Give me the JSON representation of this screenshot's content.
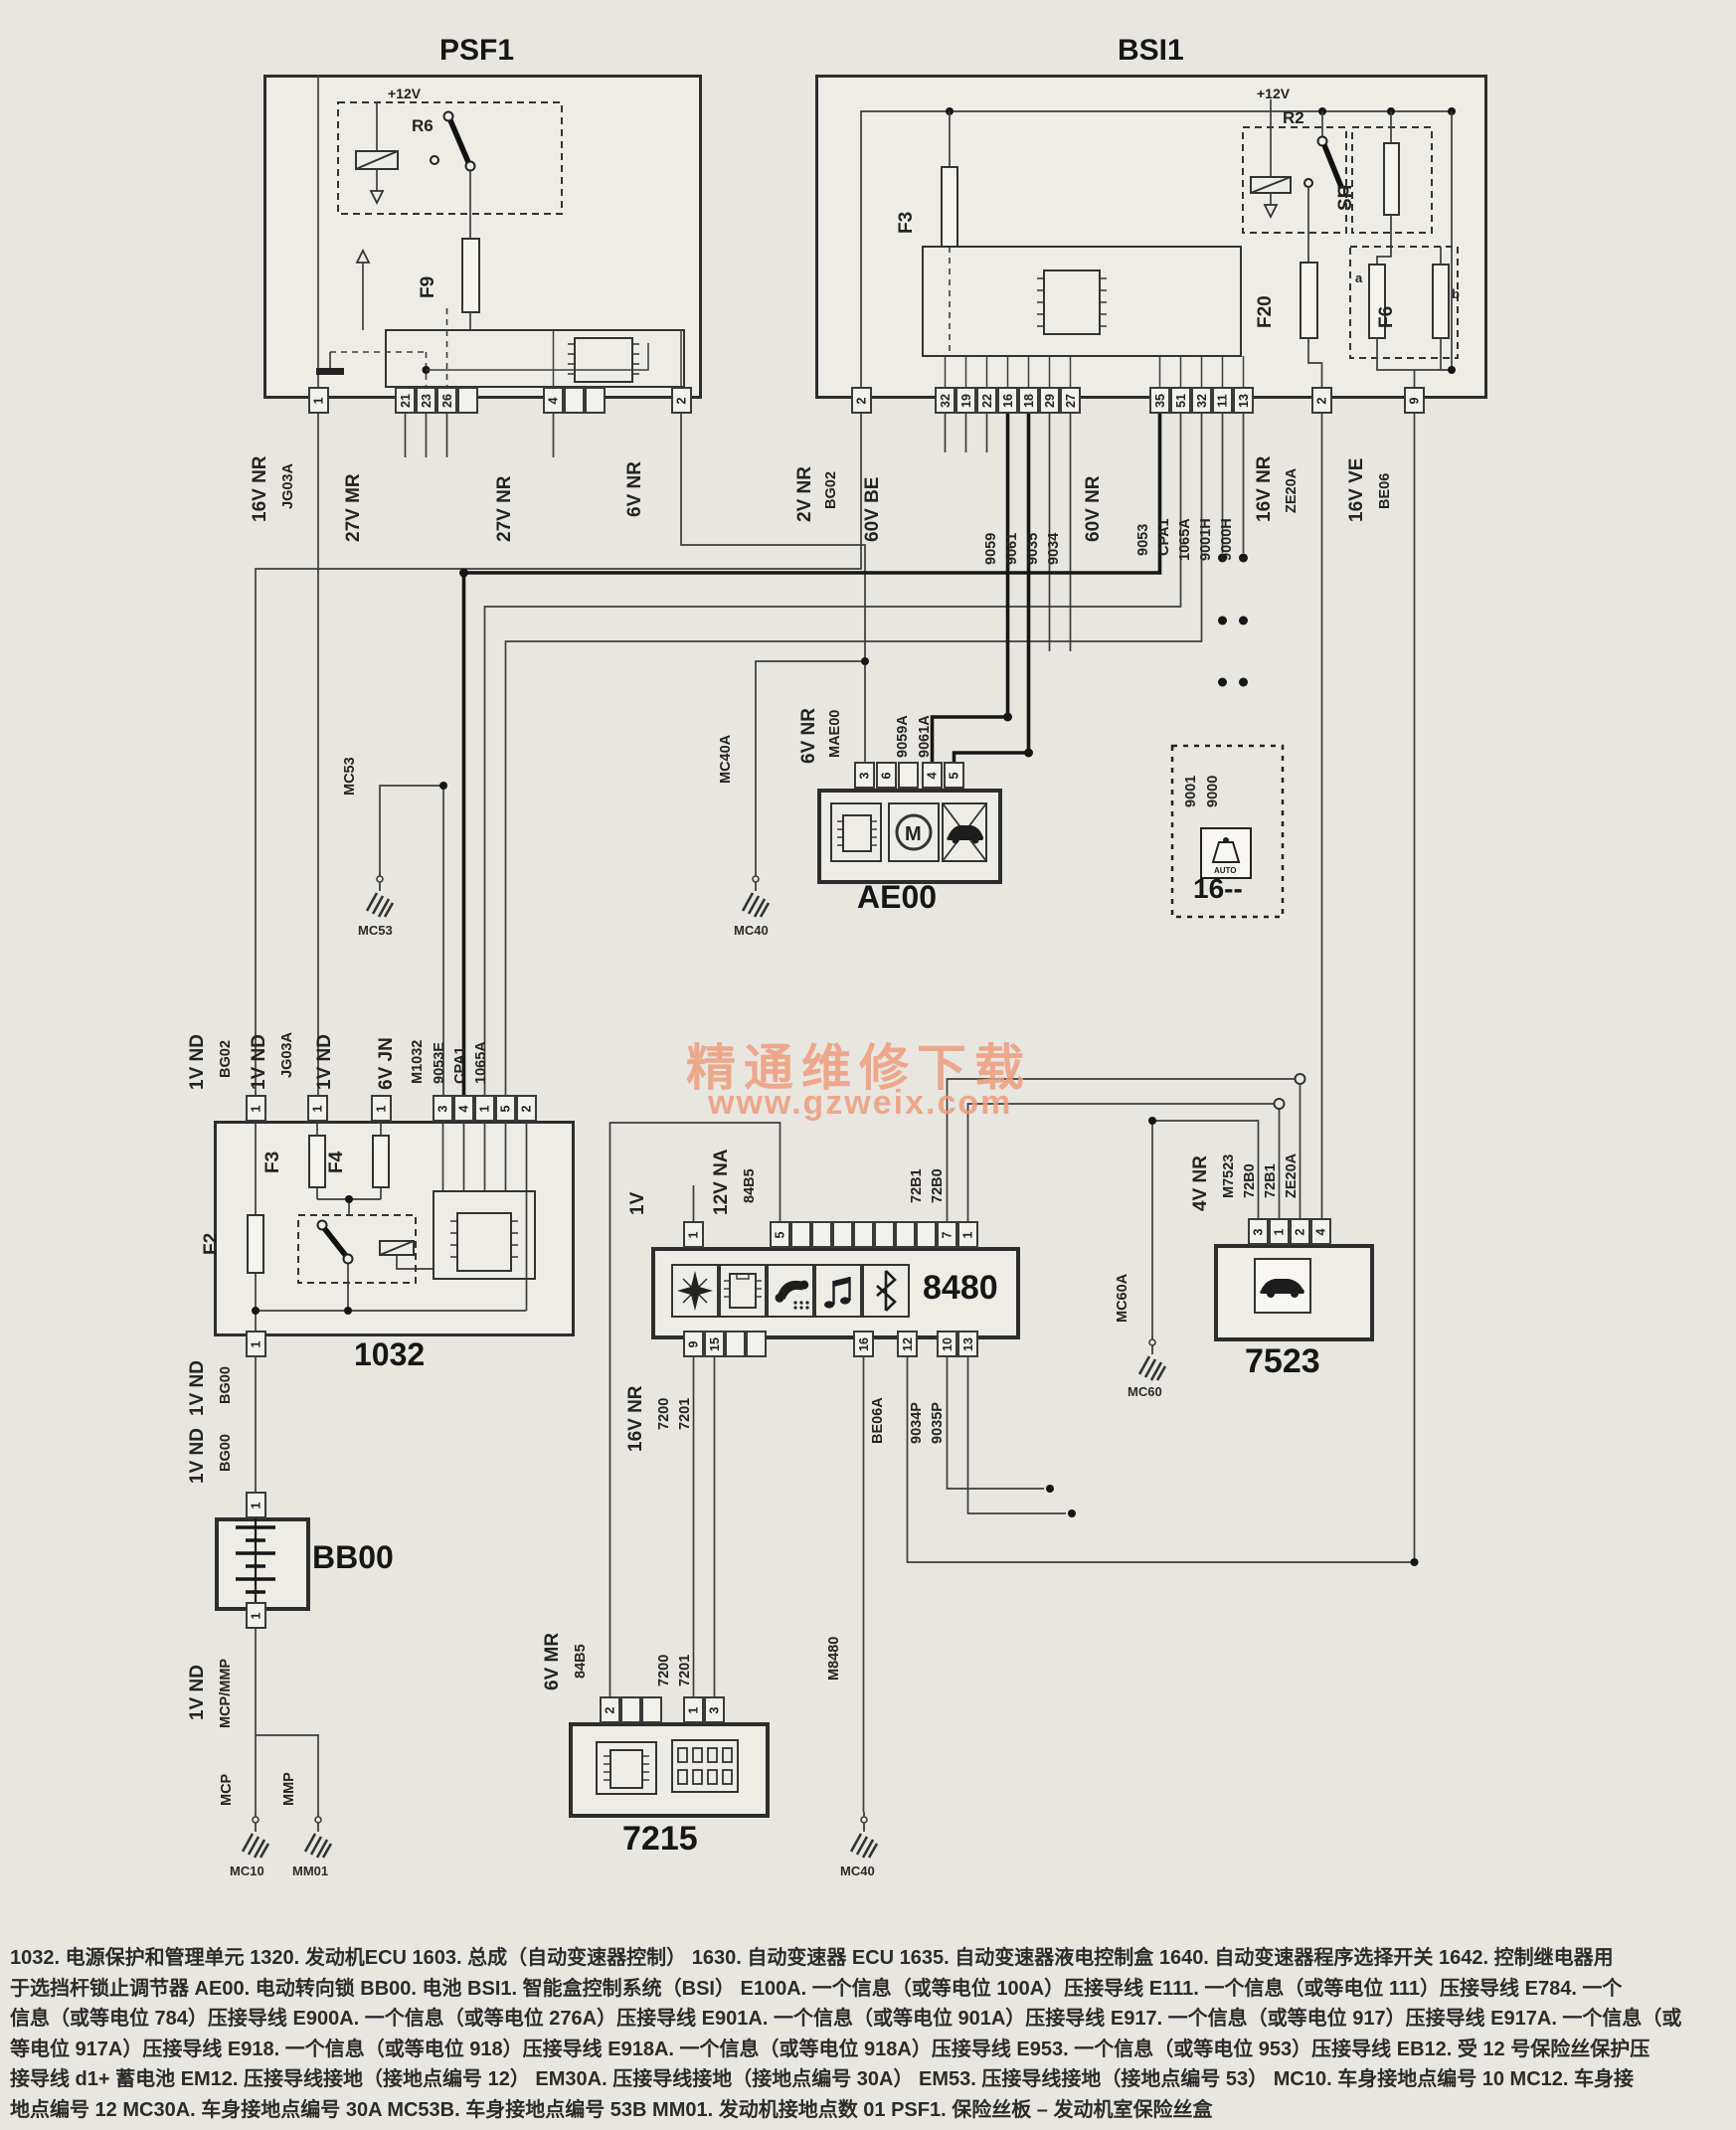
{
  "watermark": {
    "line1": "精通维修下载",
    "line2": "www.gzweix.com"
  },
  "psf1": {
    "title": "PSF1",
    "plus12": "+12V",
    "r6": "R6",
    "f9": "F9",
    "p1": "1",
    "p21": "21",
    "p23": "23",
    "p26": "26",
    "p4": "4",
    "p2": "2",
    "net16nr": "16V NR",
    "jg03a": "JG03A",
    "net27mr": "27V MR",
    "net27nr": "27V NR",
    "net6nr": "6V NR"
  },
  "bsi1": {
    "title": "BSI1",
    "plus12": "+12V",
    "r2": "R2",
    "sh": "SH",
    "f3": "F3",
    "f20": "F20",
    "f6": "F6",
    "fa": "a",
    "fb": "b",
    "p2": "2",
    "be": [
      "32",
      "19",
      "22",
      "16",
      "18",
      "29",
      "27"
    ],
    "nr": [
      "35",
      "51",
      "32",
      "11",
      "13"
    ],
    "pze": "2",
    "pbe": "9",
    "net2nr": "2V NR",
    "bg02": "BG02",
    "net60be": "60V BE",
    "w9059": "9059",
    "w9061": "9061",
    "w9035": "9035",
    "w9034": "9034",
    "net60nr": "60V NR",
    "w9053": "9053",
    "wcpa1": "CPA1",
    "w1065a": "1065A",
    "w9001h": "9001H",
    "w9000h": "9000H",
    "net16nr": "16V NR",
    "wze20a": "ZE20A",
    "net16ve": "16V VE",
    "wbe06": "BE06"
  },
  "ae00": {
    "title": "AE00",
    "p3": "3",
    "p6": "6",
    "p4": "4",
    "p5": "5",
    "net6nr": "6V NR",
    "mae00": "MAE00",
    "w9059a": "9059A",
    "w9061a": "9061A",
    "motor": "M",
    "icons": [
      "control-unit-chip",
      "motor",
      "car-alarm"
    ]
  },
  "c16": {
    "title": "16--",
    "w9001": "9001",
    "w9000": "9000",
    "auto": "AUTO",
    "icon": "auto-gearbox"
  },
  "gnd": {
    "mc53": "MC53",
    "mc53n": "MC53",
    "mc40a": "MC40A",
    "mc40n": "MC40",
    "mc60a": "MC60A",
    "mc60n": "MC60",
    "mcp": "MCP",
    "mc10": "MC10",
    "mmp": "MMP",
    "mm01": "MM01",
    "m8480": "M8480",
    "mc40b": "MC40"
  },
  "u1032": {
    "title": "1032",
    "f2": "F2",
    "f3": "F3",
    "f4": "F4",
    "net1nd": "1V ND",
    "bg02": "BG02",
    "jg03a": "JG03A",
    "net6jn": "6V JN",
    "m1032": "M1032",
    "w9053e": "9053E",
    "wcpa1": "CPA1",
    "w1065a": "1065A",
    "p1": "1",
    "p3": "3",
    "p4": "4",
    "p5": "5",
    "p2": "2",
    "bg00": "BG00"
  },
  "bb00": {
    "title": "BB00",
    "p1": "1",
    "net1nd": "1V ND",
    "bg00": "BG00",
    "mcpmmp": "MCP/MMP"
  },
  "u8480": {
    "title": "8480",
    "net1v": "1V",
    "net12na": "12V NA",
    "w84b5": "84B5",
    "w72b1": "72B1",
    "w72b0": "72B0",
    "p1": "1",
    "p5": "5",
    "p7": "7",
    "p1b": "1",
    "net16nr": "16V NR",
    "w7200": "7200",
    "w7201": "7201",
    "wm8480": "M8480",
    "wbe06a": "BE06A",
    "w9034p": "9034P",
    "w9035p": "9035P",
    "p9": "9",
    "p15": "15",
    "p16": "16",
    "p12": "12",
    "p10": "10",
    "p13": "13",
    "icons": [
      "navigation-star",
      "chip",
      "phone",
      "audio-notes",
      "bluetooth"
    ]
  },
  "u7523": {
    "title": "7523",
    "net4nr": "4V NR",
    "wm7523": "M7523",
    "w72b0": "72B0",
    "w72b1": "72B1",
    "wze20a": "ZE20A",
    "p3": "3",
    "p1": "1",
    "p2": "2",
    "p4": "4",
    "icon": "car"
  },
  "u7215": {
    "title": "7215",
    "net6mr": "6V MR",
    "w84b5": "84B5",
    "w7200": "7200",
    "w7201": "7201",
    "p2": "2",
    "p1": "1",
    "p3": "3",
    "icons": [
      "chip",
      "dip-switch"
    ]
  },
  "footer": {
    "lines": [
      "1032. 电源保护和管理单元 1320. 发动机ECU 1603. 总成（自动变速器控制） 1630. 自动变速器 ECU 1635. 自动变速器液电控制盒 1640. 自动变速器程序选择开关 1642. 控制继电器用",
      "于选挡杆锁止调节器 AE00. 电动转向锁 BB00. 电池 BSI1. 智能盒控制系统（BSI） E100A. 一个信息（或等电位 100A）压接导线 E111. 一个信息（或等电位 111）压接导线 E784. 一个",
      "信息（或等电位 784）压接导线 E900A. 一个信息（或等电位 276A）压接导线 E901A. 一个信息（或等电位 901A）压接导线 E917. 一个信息（或等电位 917）压接导线 E917A. 一个信息（或",
      "等电位 917A）压接导线 E918. 一个信息（或等电位 918）压接导线 E918A. 一个信息（或等电位 918A）压接导线 E953. 一个信息（或等电位 953）压接导线 EB12. 受 12 号保险丝保护压",
      "接导线 d1+ 蓄电池 EM12. 压接导线接地（接地点编号 12） EM30A. 压接导线接地（接地点编号 30A） EM53. 压接导线接地（接地点编号 53） MC10. 车身接地点编号 10 MC12. 车身接",
      "地点编号 12 MC30A. 车身接地点编号 30A MC53B. 车身接地点编号 53B MM01. 发动机接地点数 01 PSF1. 保险丝板 – 发动机室保险丝盒"
    ]
  }
}
